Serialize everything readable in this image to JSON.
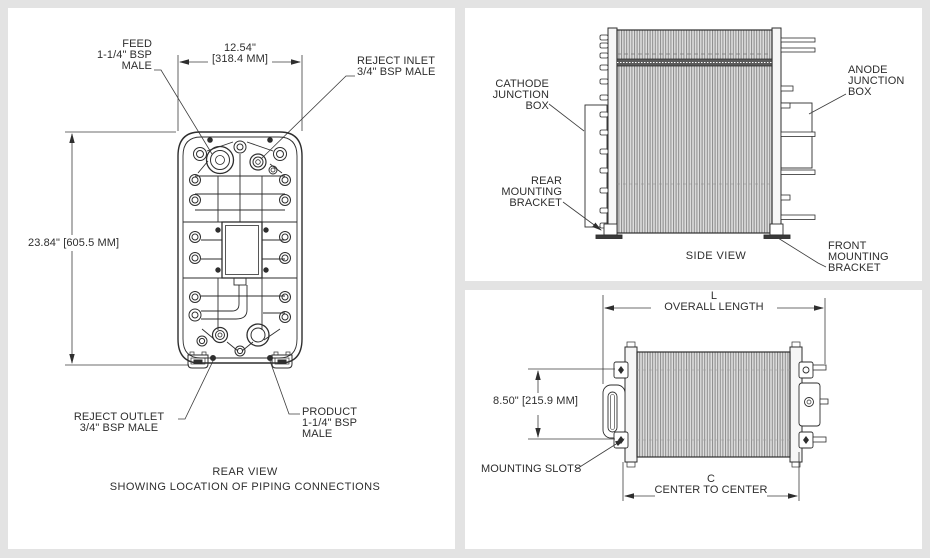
{
  "colors": {
    "page_bg": "#e3e3e3",
    "panel_bg": "#ffffff",
    "line": "#2e2e2e"
  },
  "rear_view": {
    "width_dim": "12.54\"\n[318.4 MM]",
    "height_dim": "23.84\" [605.5 MM]",
    "feed_label": "FEED\n1-1/4\" BSP\nMALE",
    "reject_inlet_label": "REJECT INLET\n3/4\" BSP MALE",
    "reject_outlet_label": "REJECT OUTLET\n3/4\" BSP MALE",
    "product_label": "PRODUCT\n1-1/4\" BSP\nMALE",
    "caption": "REAR VIEW\nSHOWING LOCATION OF PIPING CONNECTIONS"
  },
  "side_view": {
    "cathode_label": "CATHODE\nJUNCTION\nBOX",
    "anode_label": "ANODE\nJUNCTION\nBOX",
    "rear_bracket_label": "REAR\nMOUNTING\nBRACKET",
    "front_bracket_label": "FRONT\nMOUNTING\nBRACKET",
    "caption": "SIDE VIEW"
  },
  "top_view": {
    "length_dim": "L\nOVERALL LENGTH",
    "height_dim": "8.50\" [215.9 MM]",
    "mounting_slots_label": "MOUNTING SLOTS",
    "center_dim": "C\nCENTER TO CENTER"
  }
}
